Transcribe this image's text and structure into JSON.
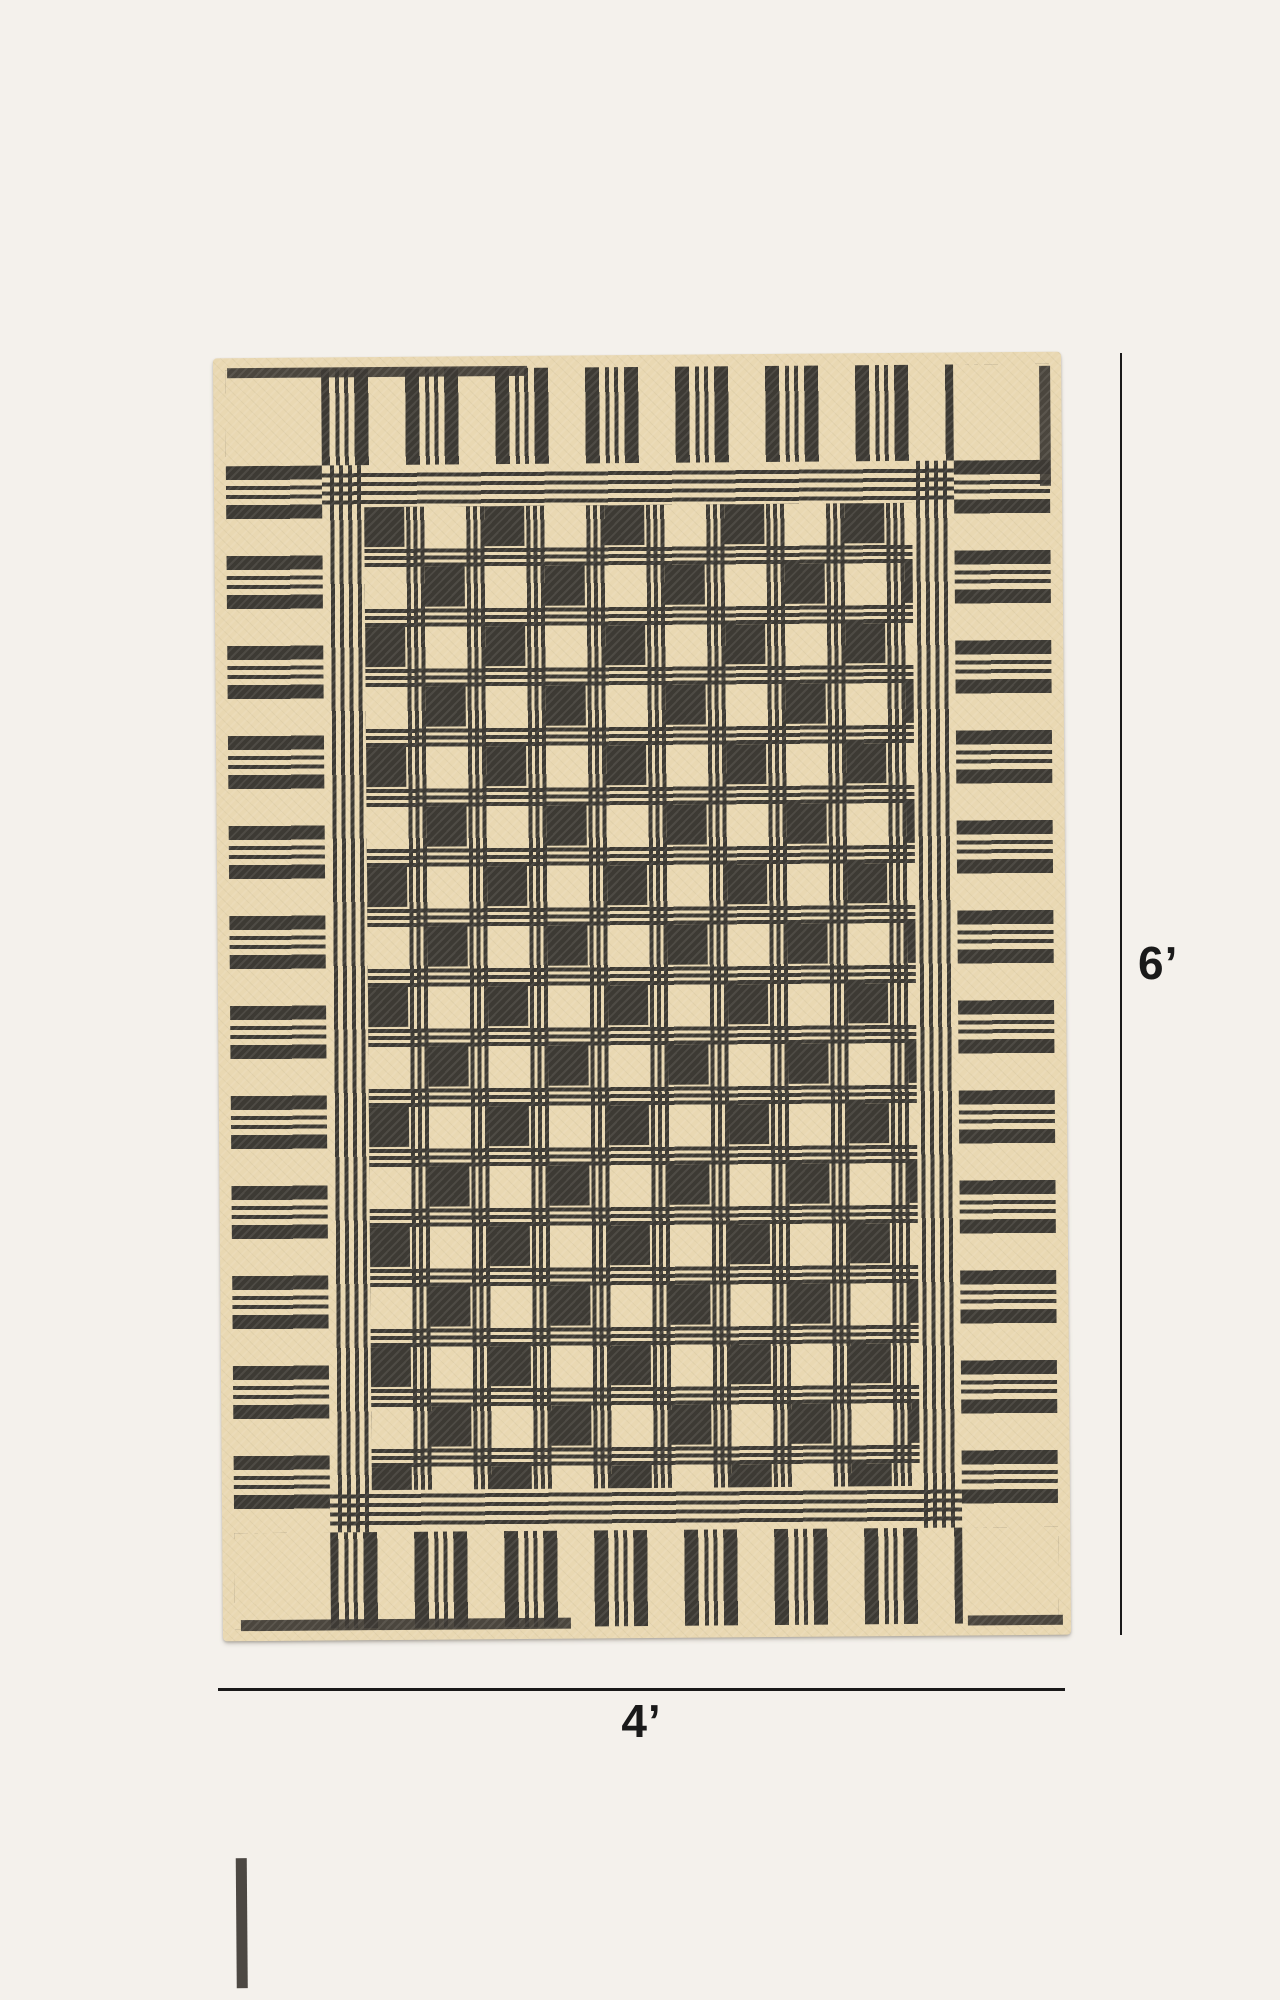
{
  "figure": {
    "type": "product-dimension-diagram",
    "subject": "Handwoven flatweave rug, cream ground with black coverlet-style plaid pattern, striped borders and plain corner blocks"
  },
  "dimensions": {
    "height_label": "6’",
    "width_label": "4’"
  },
  "colors": {
    "page_background": "#f4f1ec",
    "rug_ground": "#e9d8b2",
    "rug_pattern": "#3d3a34",
    "annotation": "#1a1a1a"
  }
}
